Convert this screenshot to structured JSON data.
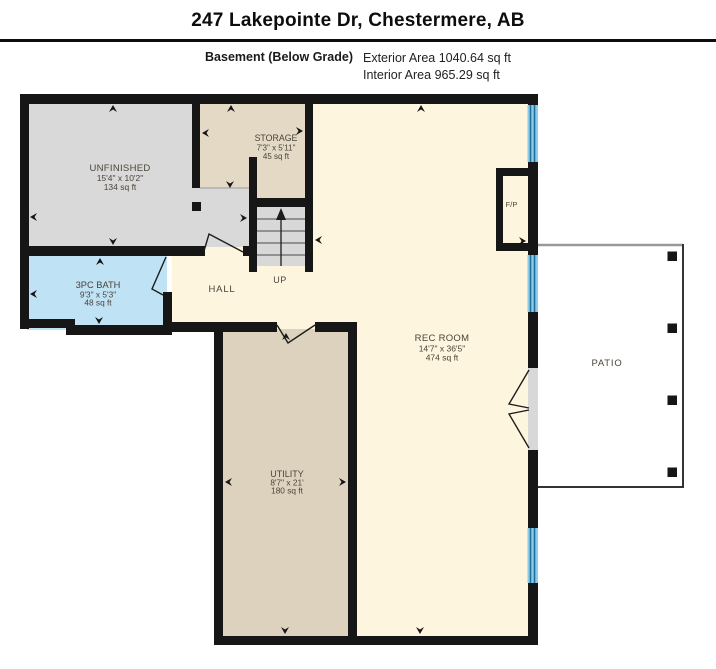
{
  "header": {
    "title": "247 Lakepointe Dr, Chestermere, AB",
    "floor_label": "Basement (Below Grade)",
    "exterior_area": "Exterior Area 1040.64 sq ft",
    "interior_area": "Interior Area 965.29 sq ft"
  },
  "rooms": {
    "unfinished": {
      "name": "UNFINISHED",
      "dimensions": "15'4\" x 10'2\"",
      "area": "134 sq ft"
    },
    "storage": {
      "name": "STORAGE",
      "dimensions": "7'3\" x 5'11\"",
      "area": "45 sq ft"
    },
    "bath": {
      "name": "3PC BATH",
      "dimensions": "9'3\" x 5'3\"",
      "area": "48 sq ft"
    },
    "hall": {
      "name": "HALL"
    },
    "stairs": {
      "label": "UP"
    },
    "rec_room": {
      "name": "REC ROOM",
      "dimensions": "14'7\" x 36'5\"",
      "area": "474 sq ft"
    },
    "utility": {
      "name": "UTILITY",
      "dimensions": "8'7\" x 21'",
      "area": "180 sq ft"
    },
    "fireplace": {
      "name": "F/P"
    },
    "patio": {
      "name": "PATIO"
    }
  },
  "colors": {
    "wall": "#161616",
    "unfinished_fill": "#d9d9d9",
    "storage_fill": "#e3d9c5",
    "bath_fill": "#bfe2f4",
    "hall_rec_fill": "#fdf5dd",
    "utility_fill": "#ddd2bd",
    "window_fill": "#8ecbe6",
    "window_line": "#1f6f9c",
    "patio_edge": "#333333",
    "patio_top_edge": "#999999"
  }
}
